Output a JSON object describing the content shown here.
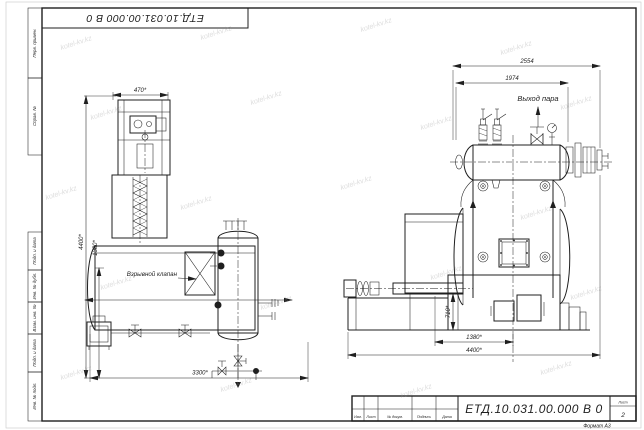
{
  "sheet": {
    "designation": "ЕТД.10.031.00.000 В 0",
    "format": "Формат А3",
    "sheet_label": "Лист",
    "sheet_number": "2",
    "title_columns": [
      "Изм.",
      "Лист",
      "№ докум.",
      "Подпись",
      "Дата"
    ],
    "side_labels": [
      "Перв. примен.",
      "Справ. №",
      "Подп. и дата",
      "Инв. № дубл.",
      "Взам. инв. №",
      "Подп. и дата",
      "Инв. № подл."
    ]
  },
  "annotations": {
    "explosion_valve": "Взрывной клапан",
    "steam_outlet": "Выход пара"
  },
  "dimensions": {
    "left_view": {
      "feeder_width": "470*",
      "total_height": "4400*",
      "shell_height": "1380*",
      "length": "3300*"
    },
    "right_view": {
      "drum_length": "2554",
      "drum_tube_span": "1974",
      "frame_height": "710*",
      "hopper_to_center": "1380*",
      "total_length": "4400*"
    }
  },
  "watermark": {
    "text": "kotel-kv.kz"
  },
  "colors": {
    "line": "#1f1f1f",
    "watermark": "#b9b9b9"
  }
}
